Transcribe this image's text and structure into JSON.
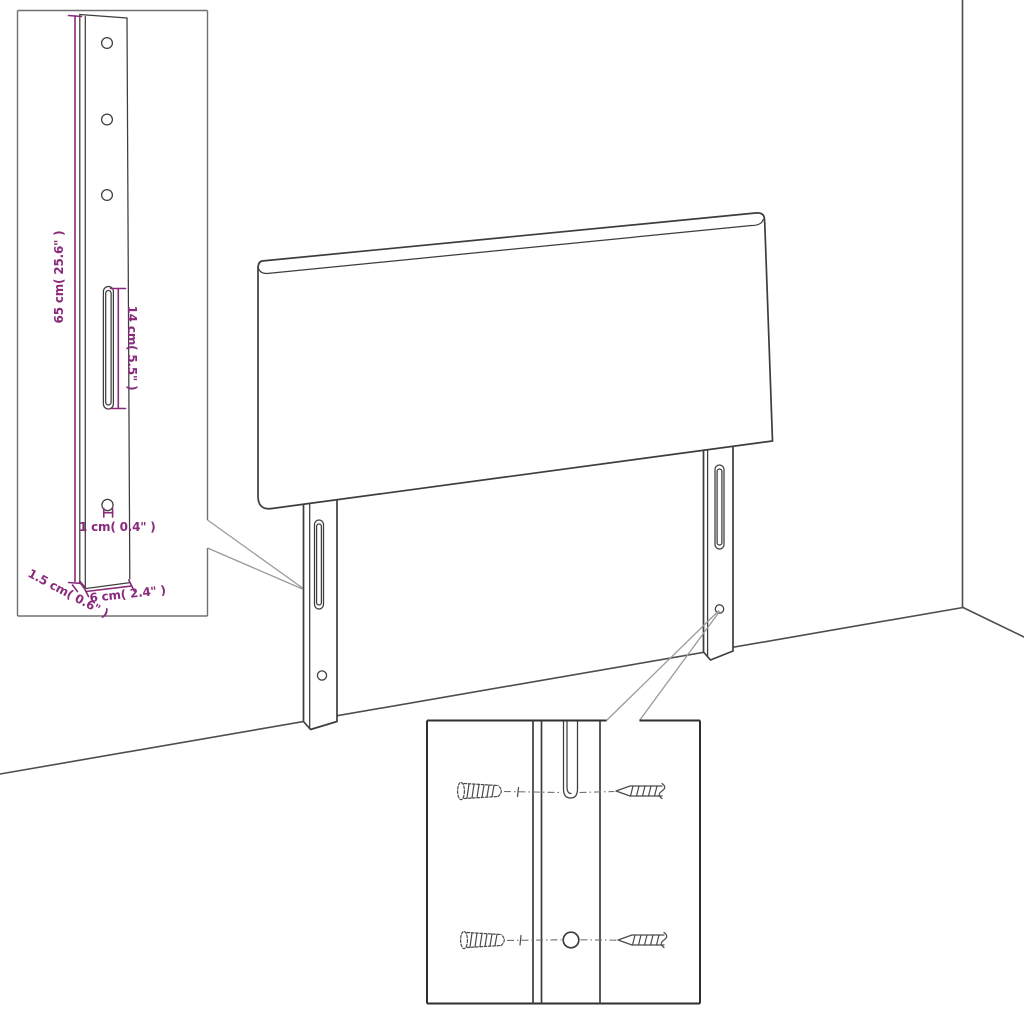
{
  "diagram": {
    "subject": "Headboard with two slotted mounting legs - dimension and wall-mounting detail drawing",
    "colors": {
      "background": "#ffffff",
      "drawing_line": "#3d3d3d",
      "dimension": "#8a2a7b",
      "callout_line": "#9a9a9a"
    },
    "labels": {
      "leg_height": "65 cm( 25.6\" )",
      "slot_length": "14 cm( 5.5\" )",
      "hole_diameter": "1 cm( 0.4\" )",
      "leg_thickness": "1.5 cm( 0.6\" )",
      "leg_width": "6 cm( 2.4\" )"
    },
    "values": {
      "leg_height_cm": 65,
      "leg_height_inch": 25.6,
      "slot_length_cm": 14,
      "slot_length_inch": 5.5,
      "hole_diameter_cm": 1,
      "hole_diameter_inch": 0.4,
      "leg_thickness_cm": 1.5,
      "leg_thickness_inch": 0.6,
      "leg_width_cm": 6,
      "leg_width_inch": 2.4
    }
  }
}
